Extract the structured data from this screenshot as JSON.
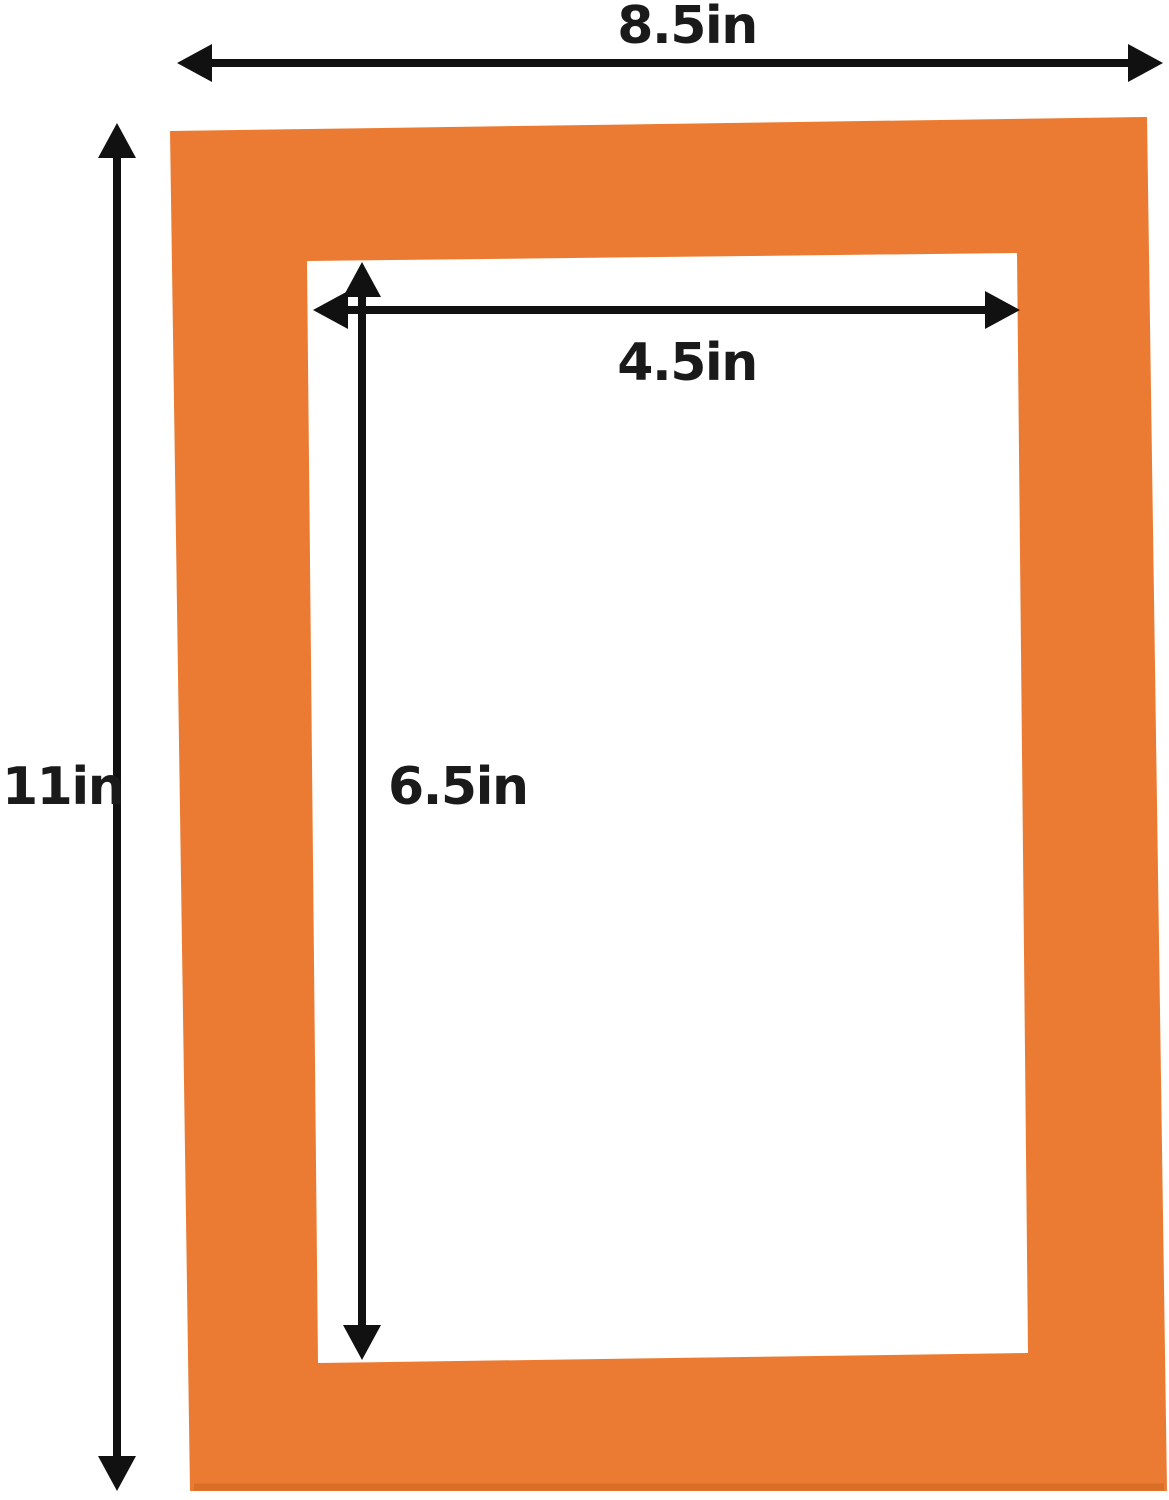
{
  "diagram": {
    "type": "product-dimension-diagram",
    "subject": "orange picture frame mat board with rectangular window opening",
    "labels": {
      "outer_width": "8.5in",
      "outer_height": "11in",
      "inner_width": "4.5in",
      "inner_height": "6.5in"
    },
    "units": "in"
  },
  "colors": {
    "mat": "#EB7B33",
    "mat_shadow": "#D96F26",
    "opening": "#FFFFFF",
    "background": "#FFFFFF",
    "arrow": "#111111",
    "text": "#1A1A1A"
  }
}
